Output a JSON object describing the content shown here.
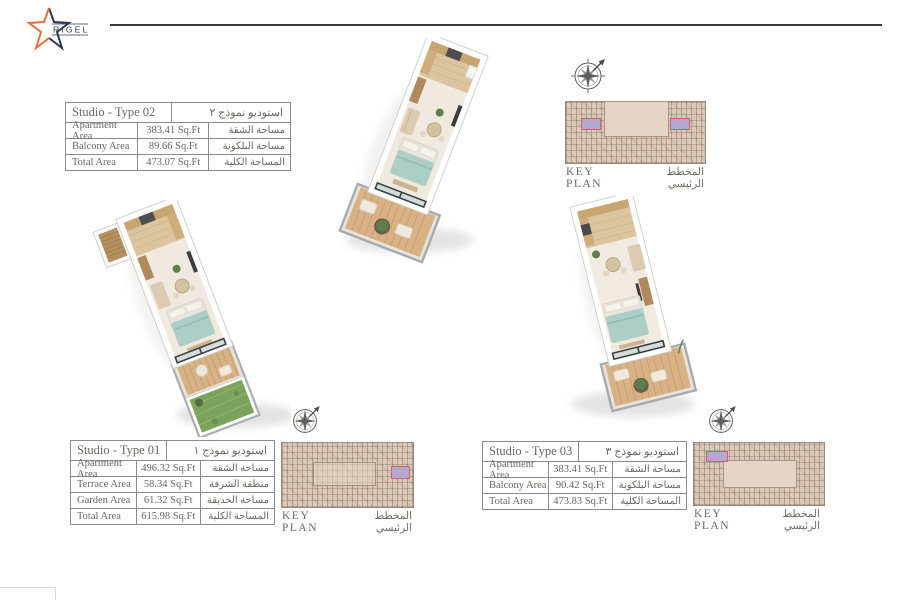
{
  "brand": {
    "name": "RIGEL"
  },
  "colors": {
    "accent_orange": "#e2703a",
    "brand_navy": "#2a3950",
    "header_rule": "#3b3b3b",
    "table_text": "#6b6762",
    "table_border": "#8c8c8c",
    "keyplan_bg": "#dbc9b9",
    "keyplan_highlight_fill": "#b3a8d2",
    "keyplan_highlight_border": "#d4606e",
    "bed_teal": "#abcfc6",
    "deck_wood": "#d8b284",
    "garden_green": "#7ca35a"
  },
  "key_plan": {
    "label_en": "KEY PLAN",
    "label_ar": "المخطط الرئيسي"
  },
  "units": {
    "type02": {
      "title_en": "Studio - Type 02",
      "title_ar": "استوديو نموذج ٢",
      "rows": [
        {
          "label_en": "Apartment Area",
          "value": "383.41 Sq.Ft",
          "label_ar": "مساحة الشقة"
        },
        {
          "label_en": "Balcony Area",
          "value": "89.66 Sq.Ft",
          "label_ar": "مساحة البلكونة"
        },
        {
          "label_en": "Total Area",
          "value": "473.07 Sq.Ft",
          "label_ar": "المساحة الكلية"
        }
      ]
    },
    "type01": {
      "title_en": "Studio - Type 01",
      "title_ar": "استوديو نموذج ١",
      "rows": [
        {
          "label_en": "Apartment Area",
          "value": "496.32 Sq.Ft",
          "label_ar": "مساحة الشقة"
        },
        {
          "label_en": "Terrace Area",
          "value": "58.34 Sq.Ft",
          "label_ar": "منطقة الشرفة"
        },
        {
          "label_en": "Garden Area",
          "value": "61.32 Sq.Ft",
          "label_ar": "مساحة الحديقة"
        },
        {
          "label_en": "Total Area",
          "value": "615.98 Sq.Ft",
          "label_ar": "المساحة الكلية"
        }
      ]
    },
    "type03": {
      "title_en": "Studio - Type 03",
      "title_ar": "استوديو نموذج ٣",
      "rows": [
        {
          "label_en": "Apartment Area",
          "value": "383.41 Sq.Ft",
          "label_ar": "مساحة الشقة"
        },
        {
          "label_en": "Balcony Area",
          "value": "90.42 Sq.Ft",
          "label_ar": "مساحة البلكونة"
        },
        {
          "label_en": "Total Area",
          "value": "473.83 Sq.Ft",
          "label_ar": "المساحة الكلية"
        }
      ]
    }
  }
}
